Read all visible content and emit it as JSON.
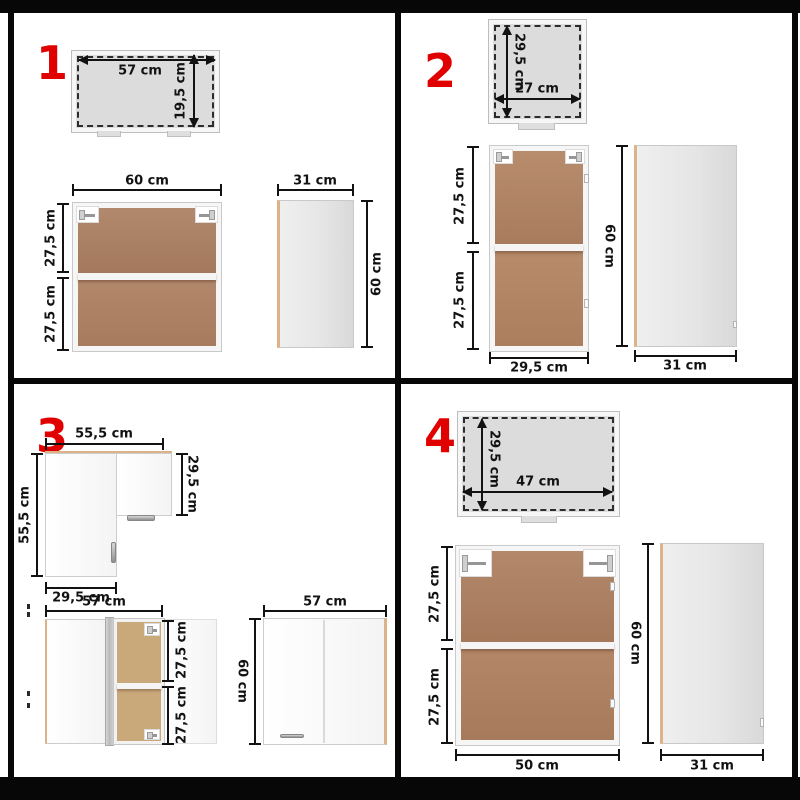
{
  "colors": {
    "accent_red": "#e10000",
    "wood_brown_dark": "#ad8062",
    "wood_brown_light": "#c9a87a",
    "edge_tan": "#ddb287",
    "top_view_gray": "#dcdcdc",
    "side_panel_gray": "#e4e4e4",
    "dimension_line": "#121212"
  },
  "q1": {
    "number": "1",
    "top_view": {
      "width": "57 cm",
      "depth": "19,5 cm"
    },
    "front_view": {
      "width": "60 cm",
      "shelf_top": "27,5 cm",
      "shelf_bottom": "27,5 cm"
    },
    "side_view": {
      "width": "31 cm",
      "height": "60 cm"
    }
  },
  "q2": {
    "number": "2",
    "top_view": {
      "depth": "29,5 cm",
      "width": "27 cm"
    },
    "front_view": {
      "shelf_top": "27,5 cm",
      "shelf_bottom": "27,5 cm",
      "width": "29,5 cm"
    },
    "side_view": {
      "height": "60 cm",
      "width": "31 cm"
    }
  },
  "q3": {
    "number": "3",
    "corner_top_view": {
      "width": "55,5 cm",
      "depth": "55,5 cm",
      "right_depth": "29,5 cm",
      "bottom_width": "29,5 cm"
    },
    "open_view": {
      "width": "57 cm",
      "shelf_top": "27,5 cm",
      "shelf_bottom": "27,5 cm"
    },
    "closed_view": {
      "width": "57 cm",
      "height": "60 cm"
    }
  },
  "q4": {
    "number": "4",
    "top_view": {
      "depth": "29,5 cm",
      "width": "47 cm"
    },
    "front_view": {
      "shelf_top": "27,5 cm",
      "shelf_bottom": "27,5 cm",
      "width": "50 cm"
    },
    "side_view": {
      "height": "60 cm",
      "width": "31 cm"
    }
  }
}
